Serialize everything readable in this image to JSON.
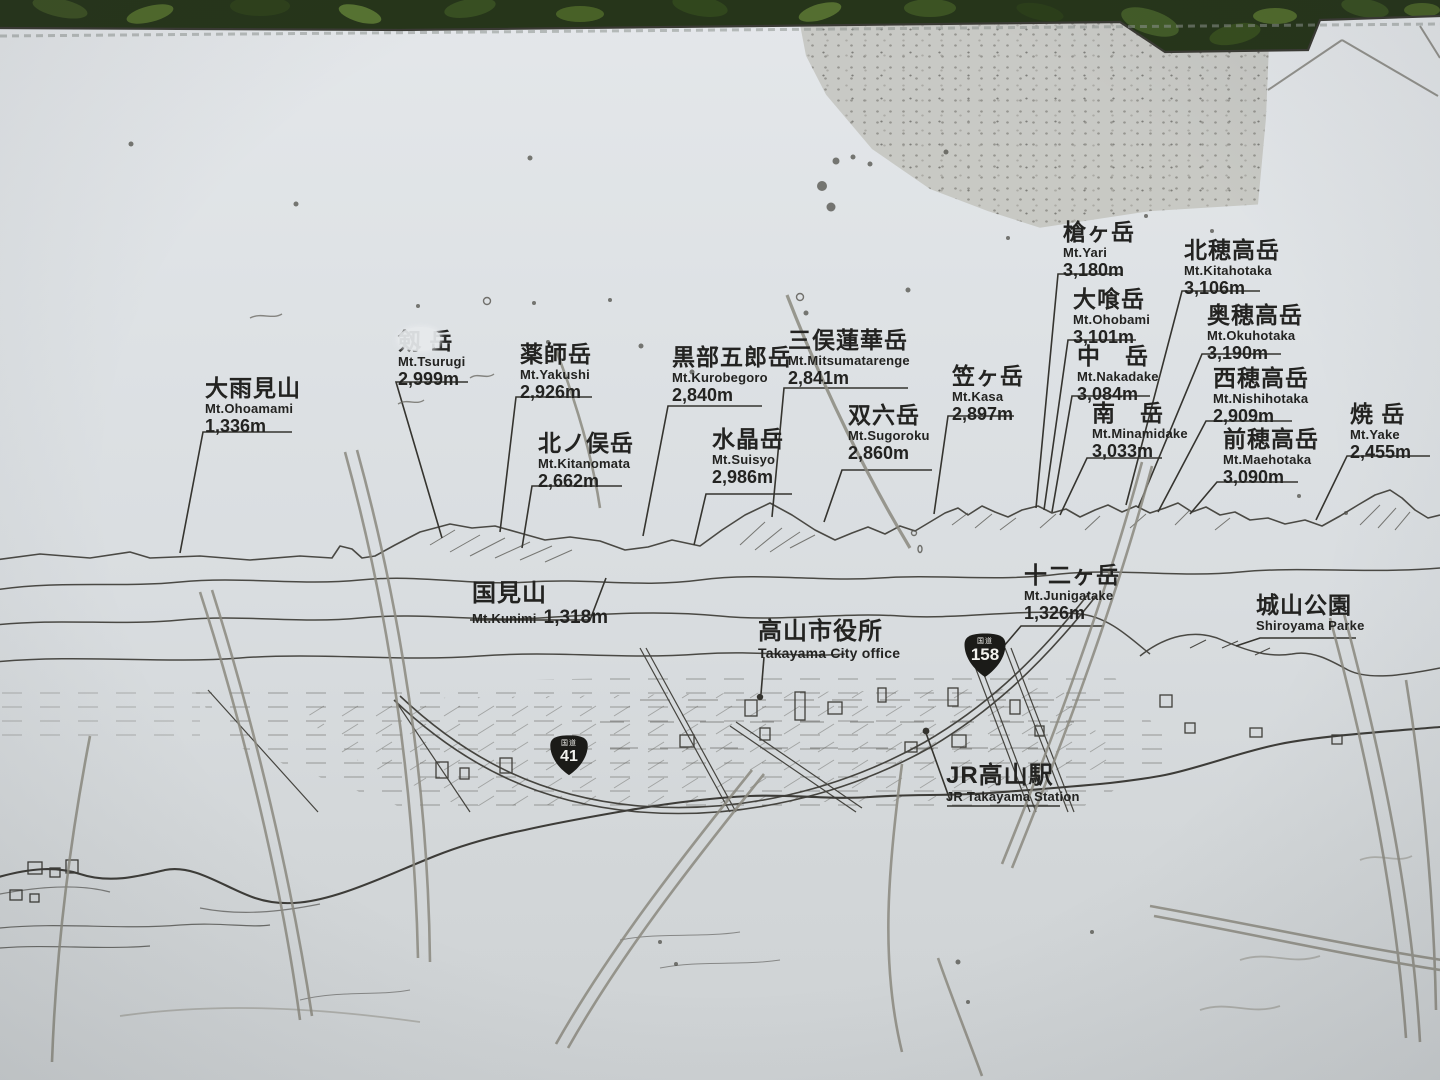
{
  "sign_title": "Mountain panorama identification board (Takayama)",
  "peaks": [
    {
      "kanji": "大雨見山",
      "romaji": "Mt.Ohoamami",
      "elevation": "1,336m"
    },
    {
      "kanji": "剱 岳",
      "romaji": "Mt.Tsurugi",
      "elevation": "2,999m"
    },
    {
      "kanji": "薬師岳",
      "romaji": "Mt.Yakushi",
      "elevation": "2,926m"
    },
    {
      "kanji": "北ノ俣岳",
      "romaji": "Mt.Kitanomata",
      "elevation": "2,662m"
    },
    {
      "kanji": "黒部五郎岳",
      "romaji": "Mt.Kurobegoro",
      "elevation": "2,840m"
    },
    {
      "kanji": "水晶岳",
      "romaji": "Mt.Suisyo",
      "elevation": "2,986m"
    },
    {
      "kanji": "三俣蓮華岳",
      "romaji": "Mt.Mitsumatarenge",
      "elevation": "2,841m"
    },
    {
      "kanji": "双六岳",
      "romaji": "Mt.Sugoroku",
      "elevation": "2,860m"
    },
    {
      "kanji": "笠ヶ岳",
      "romaji": "Mt.Kasa",
      "elevation": "2,897m"
    },
    {
      "kanji": "槍ヶ岳",
      "romaji": "Mt.Yari",
      "elevation": "3,180m"
    },
    {
      "kanji": "大喰岳",
      "romaji": "Mt.Ohobami",
      "elevation": "3,101m"
    },
    {
      "kanji": "中　岳",
      "romaji": "Mt.Nakadake",
      "elevation": "3,084m"
    },
    {
      "kanji": "南　岳",
      "romaji": "Mt.Minamidake",
      "elevation": "3,033m"
    },
    {
      "kanji": "北穂高岳",
      "romaji": "Mt.Kitahotaka",
      "elevation": "3,106m"
    },
    {
      "kanji": "奥穂高岳",
      "romaji": "Mt.Okuhotaka",
      "elevation": "3,190m"
    },
    {
      "kanji": "西穂高岳",
      "romaji": "Mt.Nishihotaka",
      "elevation": "2,909m"
    },
    {
      "kanji": "前穂高岳",
      "romaji": "Mt.Maehotaka",
      "elevation": "3,090m"
    },
    {
      "kanji": "焼 岳",
      "romaji": "Mt.Yake",
      "elevation": "2,455m"
    }
  ],
  "landmarks": {
    "kunimi": {
      "kanji": "国見山",
      "romaji": "Mt.Kunimi",
      "elevation": "1,318m"
    },
    "junigatake": {
      "kanji": "十二ヶ岳",
      "romaji": "Mt.Junigatake",
      "elevation": "1,326m"
    },
    "shiroyama": {
      "kanji": "城山公園",
      "romaji": "Shiroyama Parke"
    },
    "city_office": {
      "kanji": "高山市役所",
      "romaji": "Takayama City office"
    },
    "station": {
      "kanji": "JR高山駅",
      "romaji": "JR Takayama Station"
    }
  },
  "route_shields": [
    {
      "number": "158",
      "caption": "国道"
    },
    {
      "number": "41",
      "caption": "国道"
    }
  ],
  "colors": {
    "panel": "#dde1e4",
    "line_art": "#4a4944",
    "label_text": "#232321",
    "stain": "#c6c7c2",
    "foliage": "#2b3d1b",
    "shield": "#1b1b18"
  }
}
